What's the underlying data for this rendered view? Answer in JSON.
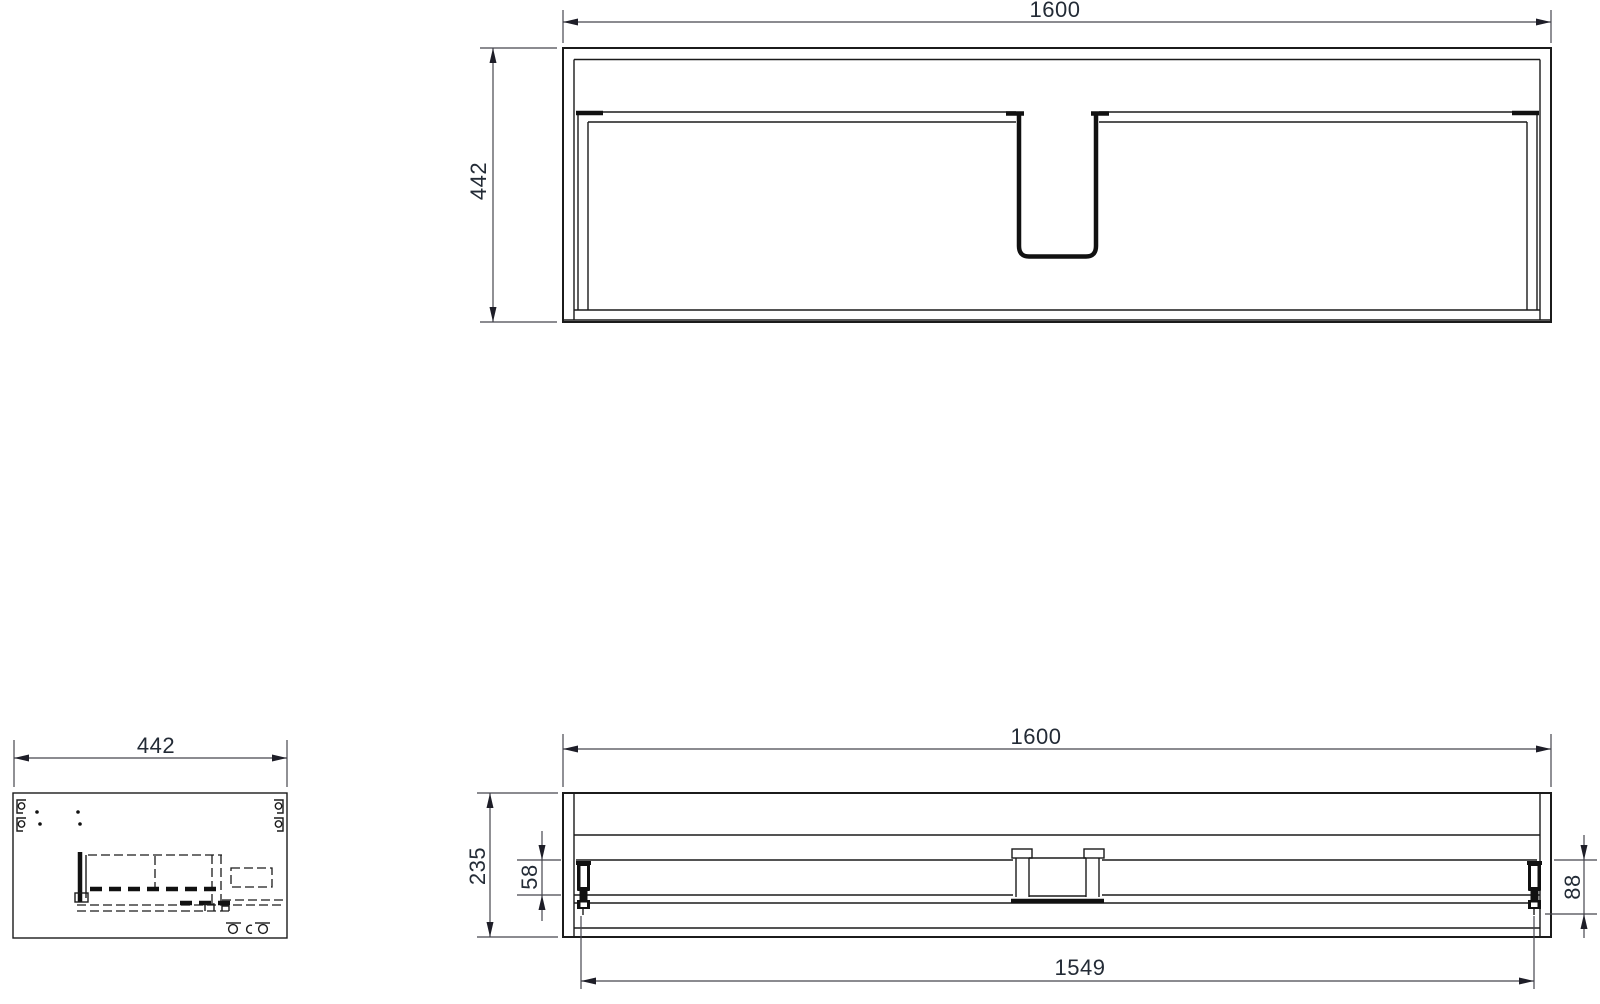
{
  "drawing_title": "cabinet dimensional drawing",
  "views": {
    "plan": {
      "width": "1600",
      "depth": "442"
    },
    "side": {
      "depth": "442"
    },
    "front": {
      "width": "1600",
      "height": "235",
      "drawer_top_offset": "58",
      "slide_height": "88",
      "inner_width": "1549"
    }
  },
  "colors": {
    "line": "#1b1b1b",
    "dimension": "#46464e",
    "text": "#232b36",
    "background": "#ffffff"
  }
}
